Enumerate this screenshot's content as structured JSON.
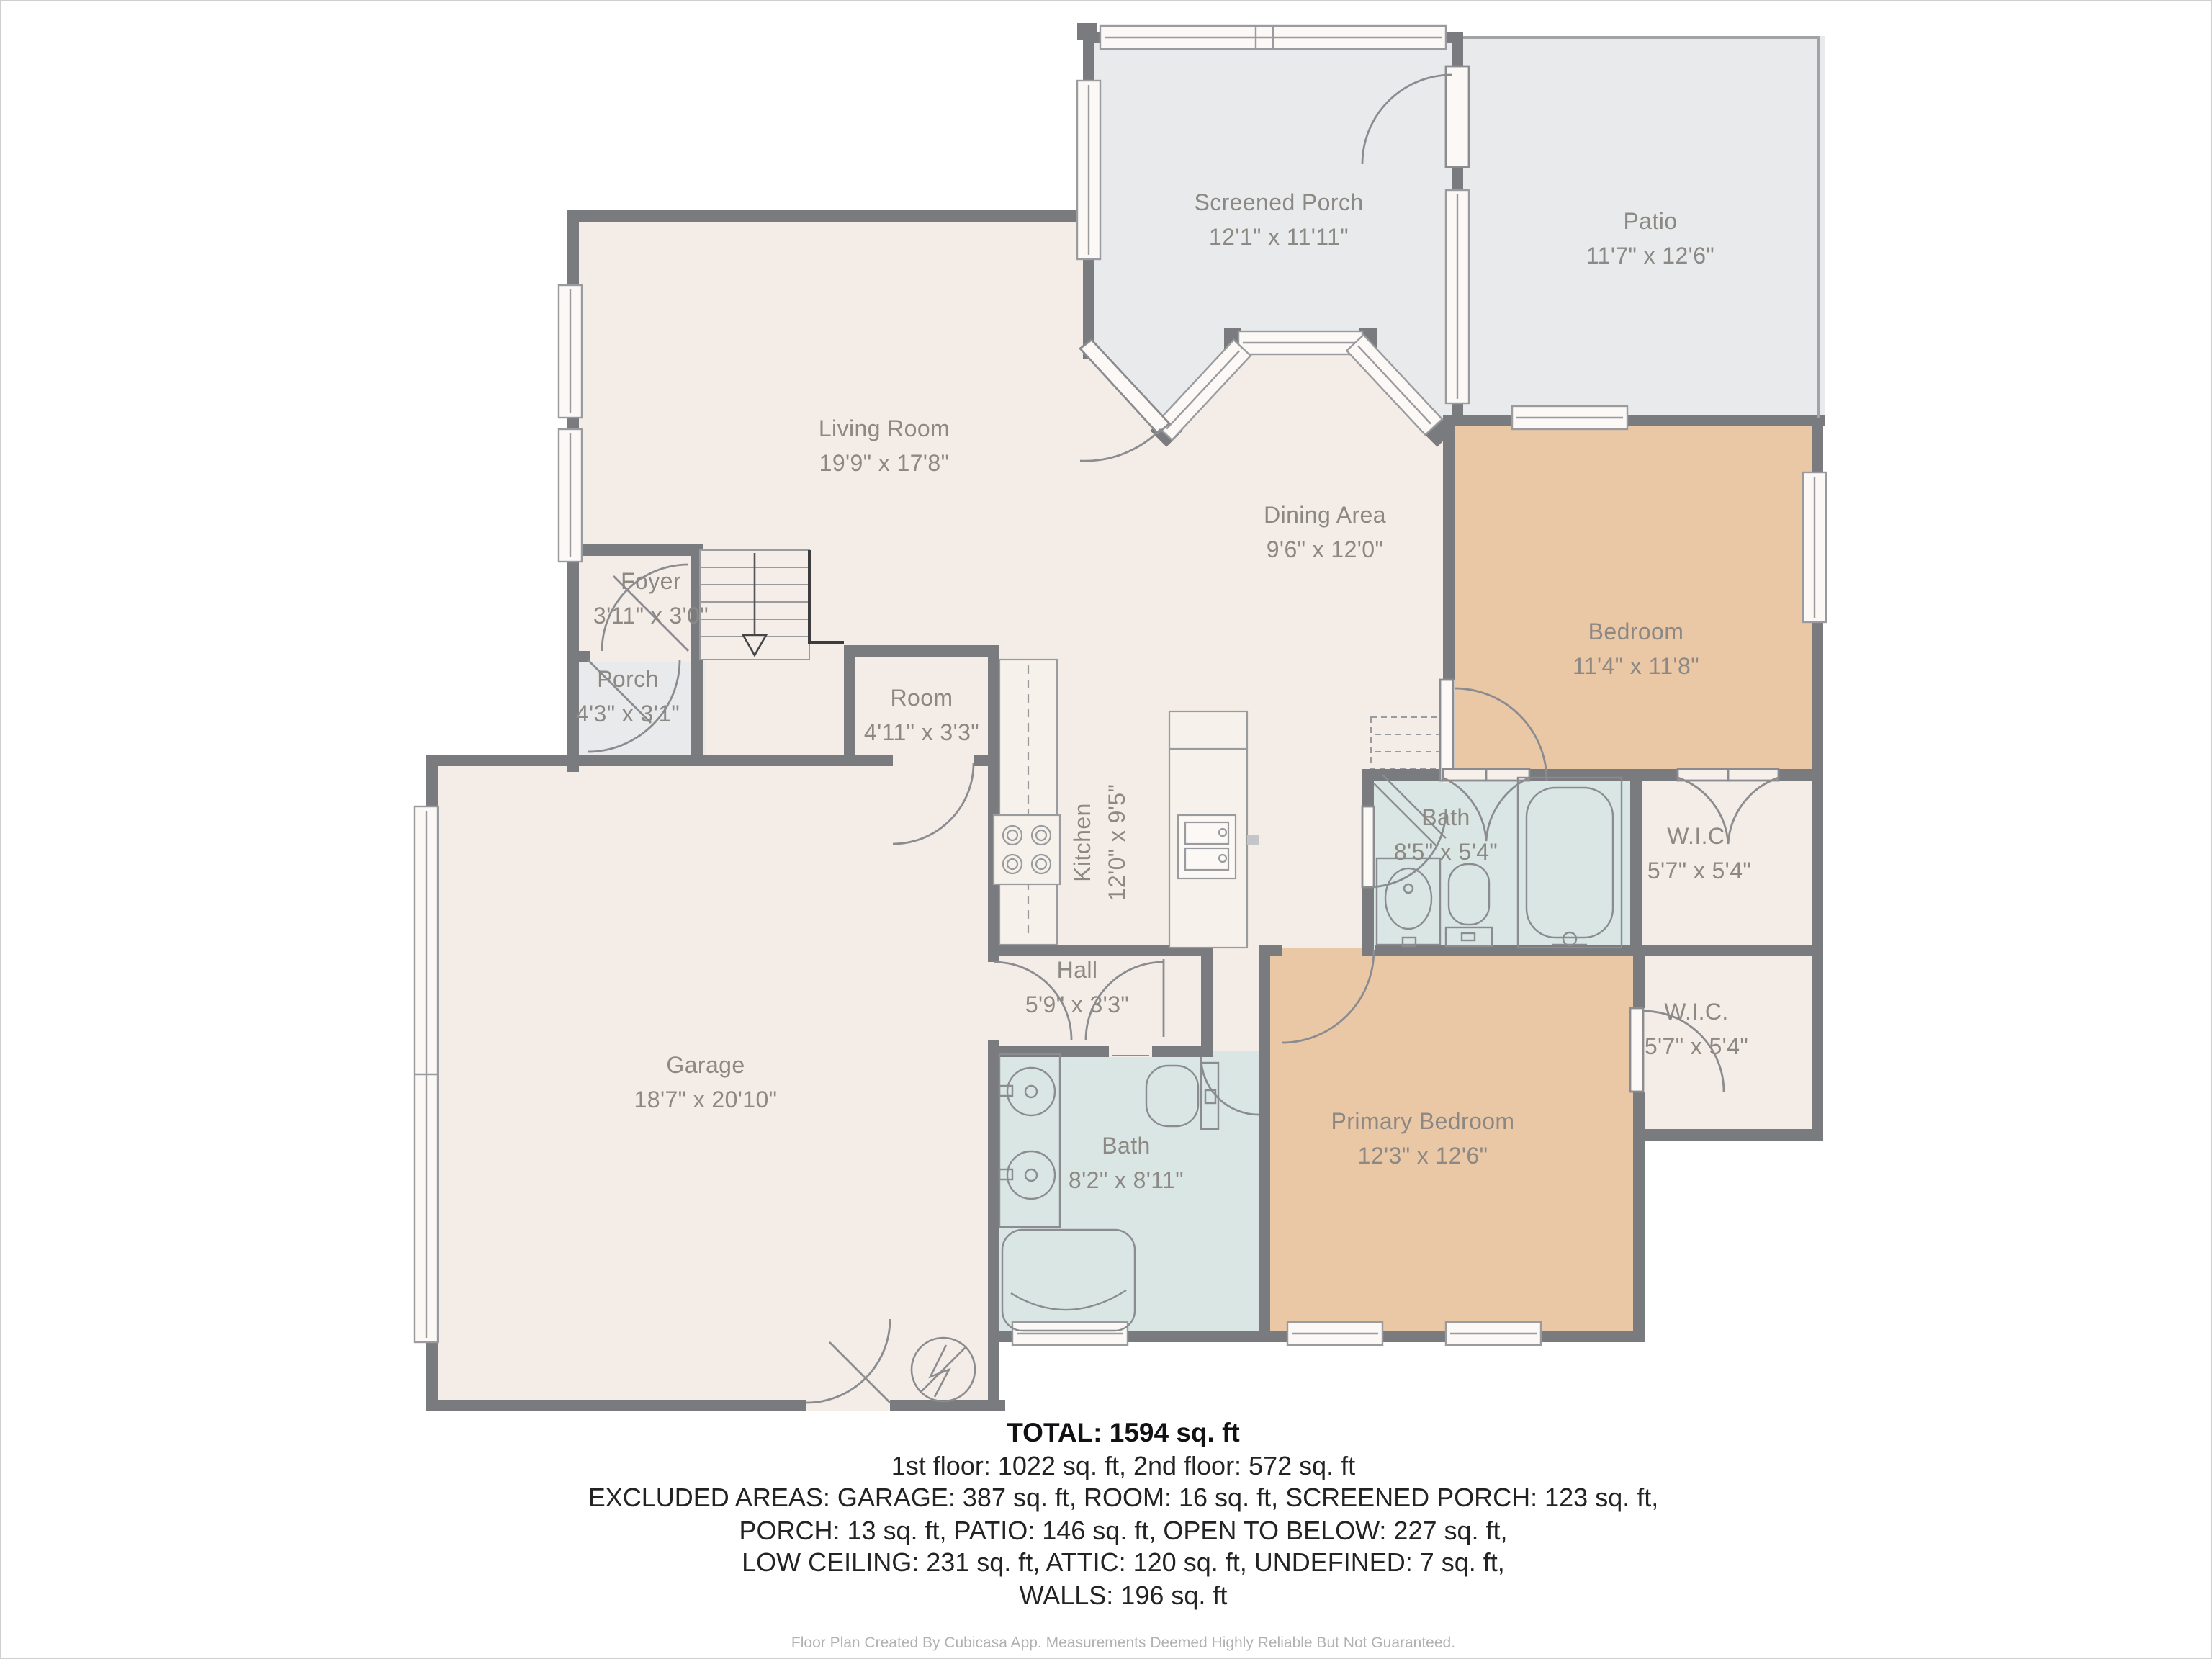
{
  "plan": {
    "title": "Floor plan",
    "rooms": [
      {
        "id": "screened-porch",
        "name": "Screened Porch",
        "dims": "12'1\" x 11'11\""
      },
      {
        "id": "patio",
        "name": "Patio",
        "dims": "11'7\" x 12'6\""
      },
      {
        "id": "living-room",
        "name": "Living Room",
        "dims": "19'9\" x 17'8\""
      },
      {
        "id": "dining-area",
        "name": "Dining Area",
        "dims": "9'6\" x 12'0\""
      },
      {
        "id": "bedroom",
        "name": "Bedroom",
        "dims": "11'4\" x 11'8\""
      },
      {
        "id": "foyer",
        "name": "Foyer",
        "dims": "3'11\" x 3'0\""
      },
      {
        "id": "porch",
        "name": "Porch",
        "dims": "4'3\" x 3'1\""
      },
      {
        "id": "room",
        "name": "Room",
        "dims": "4'11\" x 3'3\""
      },
      {
        "id": "kitchen",
        "name": "Kitchen",
        "dims": "12'0\" x 9'5\""
      },
      {
        "id": "bath",
        "name": "Bath",
        "dims": "8'5\" x 5'4\""
      },
      {
        "id": "wic-1",
        "name": "W.I.C.",
        "dims": "5'7\" x 5'4\""
      },
      {
        "id": "hall",
        "name": "Hall",
        "dims": "5'9\" x 3'3\""
      },
      {
        "id": "garage",
        "name": "Garage",
        "dims": "18'7\" x 20'10\""
      },
      {
        "id": "bath-2",
        "name": "Bath",
        "dims": "8'2\" x 8'11\""
      },
      {
        "id": "primary-bedroom",
        "name": "Primary Bedroom",
        "dims": "12'3\" x 12'6\""
      },
      {
        "id": "wic-2",
        "name": "W.I.C.",
        "dims": "5'7\" x 5'4\""
      }
    ],
    "summary": {
      "total": "TOTAL: 1594 sq. ft",
      "floors": "1st floor: 1022 sq. ft, 2nd floor: 572 sq. ft",
      "excluded_1": "EXCLUDED AREAS: GARAGE: 387 sq. ft, ROOM: 16 sq. ft, SCREENED PORCH: 123 sq. ft,",
      "excluded_2": "PORCH: 13 sq. ft, PATIO: 146 sq. ft, OPEN TO BELOW: 227 sq. ft,",
      "excluded_3": "LOW CEILING: 231 sq. ft, ATTIC: 120 sq. ft, UNDEFINED: 7 sq. ft,",
      "excluded_4": "WALLS: 196 sq. ft"
    },
    "footer": "Floor Plan Created By Cubicasa App. Measurements Deemed Highly Reliable But Not Guaranteed.",
    "colors": {
      "floor": "#f4ece6",
      "outdoor": "#e9eaec",
      "bedroom_fill": "#ebc8a5",
      "bath_fill": "#d9e6e3",
      "wall": "#7a7b7e",
      "label_text": "#8c8884"
    }
  }
}
